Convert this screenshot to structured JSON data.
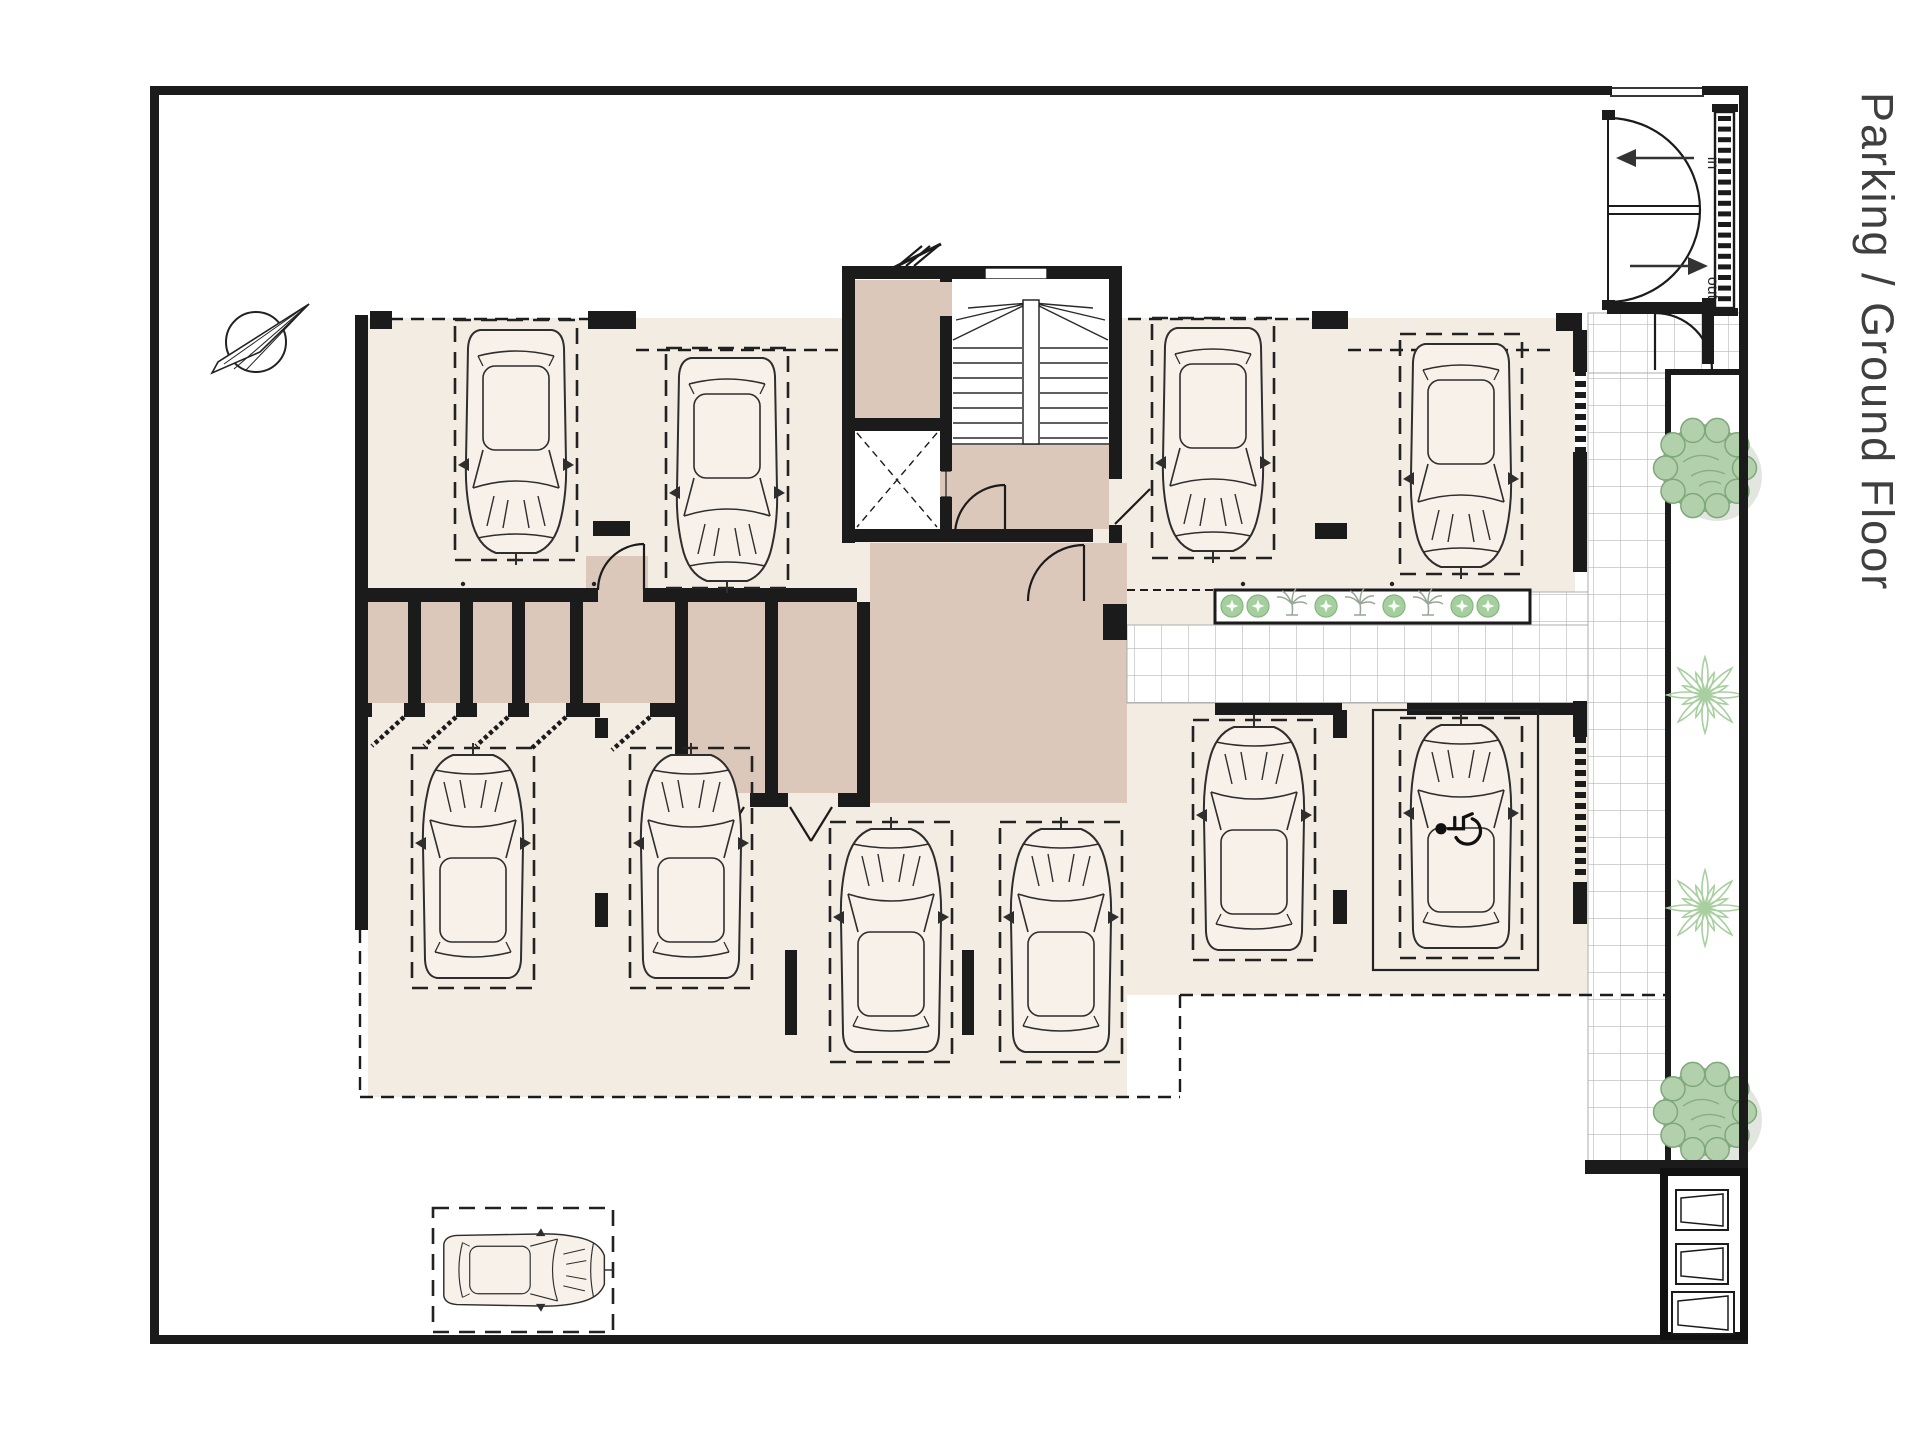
{
  "title": {
    "text": "Parking / Ground Floor"
  },
  "entrance": {
    "in_label": "in",
    "out_label": "out"
  },
  "colors": {
    "floor_light": "#f3ece3",
    "room_dark": "#dcc8ba",
    "wall": "#1b1b1b",
    "tile_line": "#b8b8b8",
    "plant_green": "#a6cf9f",
    "tree_green": "#b2d0ac",
    "car_fill": "#f7f1e9"
  },
  "parking": {
    "spaces": [
      {
        "id": "P1",
        "x": 455,
        "y": 320,
        "facing": "down"
      },
      {
        "id": "P2",
        "x": 666,
        "y": 348,
        "facing": "down"
      },
      {
        "id": "P3",
        "x": 1152,
        "y": 318,
        "facing": "down"
      },
      {
        "id": "P4",
        "x": 1400,
        "y": 334,
        "facing": "down"
      },
      {
        "id": "P5",
        "x": 412,
        "y": 748,
        "facing": "up"
      },
      {
        "id": "P6",
        "x": 630,
        "y": 748,
        "facing": "up"
      },
      {
        "id": "P7",
        "x": 830,
        "y": 822,
        "facing": "up"
      },
      {
        "id": "P8",
        "x": 1000,
        "y": 822,
        "facing": "up"
      },
      {
        "id": "P9",
        "x": 1193,
        "y": 720,
        "facing": "up"
      },
      {
        "id": "P10",
        "x": 1400,
        "y": 718,
        "facing": "up",
        "accessible": true,
        "pad": {
          "x": 1373,
          "y": 710,
          "w": 165,
          "h": 260
        }
      },
      {
        "id": "P11",
        "x": 433,
        "y": 1208,
        "w": 180,
        "h": 124,
        "facing": "right",
        "scale": 0.72
      }
    ]
  },
  "landscaping": {
    "vertical_planter": [
      {
        "type": "tree",
        "x": 1705,
        "y": 468
      },
      {
        "type": "star",
        "x": 1705,
        "y": 695
      },
      {
        "type": "star",
        "x": 1705,
        "y": 908
      },
      {
        "type": "tree",
        "x": 1705,
        "y": 1112
      }
    ],
    "palm_strip": [
      {
        "type": "shrub",
        "x": 1232
      },
      {
        "type": "shrub",
        "x": 1258
      },
      {
        "type": "palm",
        "x": 1292
      },
      {
        "type": "shrub",
        "x": 1326
      },
      {
        "type": "palm",
        "x": 1360
      },
      {
        "type": "shrub",
        "x": 1394
      },
      {
        "type": "palm",
        "x": 1428
      },
      {
        "type": "shrub",
        "x": 1462
      },
      {
        "type": "shrub",
        "x": 1488
      }
    ]
  }
}
